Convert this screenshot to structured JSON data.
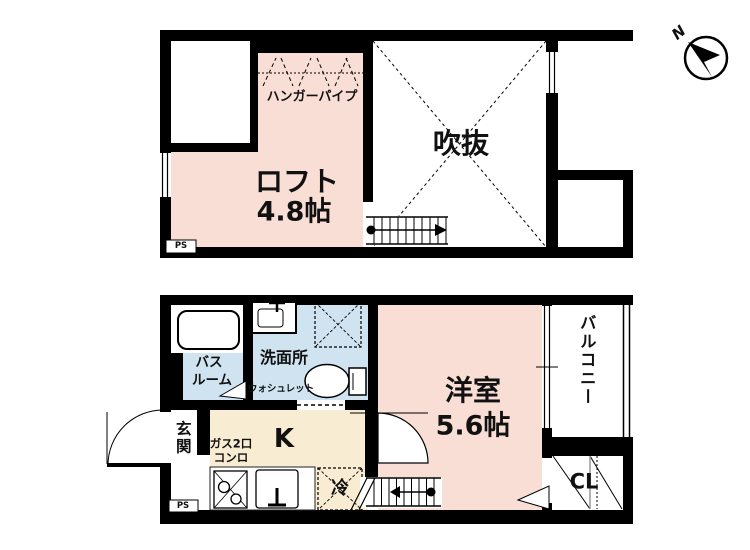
{
  "colors": {
    "room": "#f8ded4",
    "wet": "#cfe3f1",
    "kitchen": "#f8ecd2",
    "wall": "#000000"
  },
  "compass": {
    "north": "N"
  },
  "upper": {
    "loft_name": "ロフト",
    "loft_size": "4.8帖",
    "hanger_pipe": "ハンガーパイプ",
    "void": "吹抜",
    "ps": "PS"
  },
  "lower": {
    "room_name": "洋室",
    "room_size": "5.6帖",
    "kitchen": "K",
    "stove1": "ガス2口",
    "stove2": "コンロ",
    "bath1": "バス",
    "bath2": "ルーム",
    "washroom": "洗面所",
    "washlet": "ウォシュレット",
    "entrance": "玄関",
    "balcony": "バルコニー",
    "closet": "CL",
    "fridge": "冷",
    "ps": "PS"
  }
}
